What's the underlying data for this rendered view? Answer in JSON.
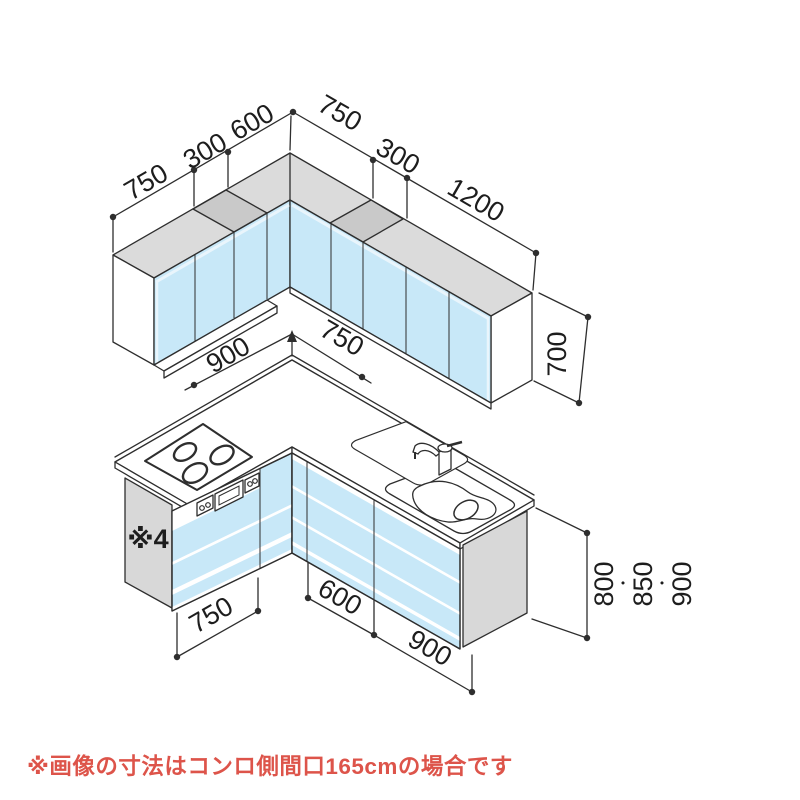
{
  "diagram": {
    "upper": {
      "left_dims": [
        "750",
        "300",
        "600"
      ],
      "right_dims": [
        "750",
        "300",
        "1200"
      ],
      "height": "700"
    },
    "middle": {
      "left_width": "900",
      "right_width": "750"
    },
    "base": {
      "panel_note": "※4",
      "front_left": "750",
      "front_mid": "600",
      "front_right": "900",
      "heights": [
        "800",
        "850",
        "900"
      ],
      "separator": "・"
    },
    "caption": "※画像の寸法はコンロ側間口165cmの場合です",
    "colors": {
      "front_blue": "#c8e8f8",
      "top_gray": "#dbdbdb",
      "filler_gray": "#c9c9c9",
      "panel_gray": "#d8d8d8",
      "line": "#2e2e2e",
      "caption_red": "#dd544a"
    }
  }
}
